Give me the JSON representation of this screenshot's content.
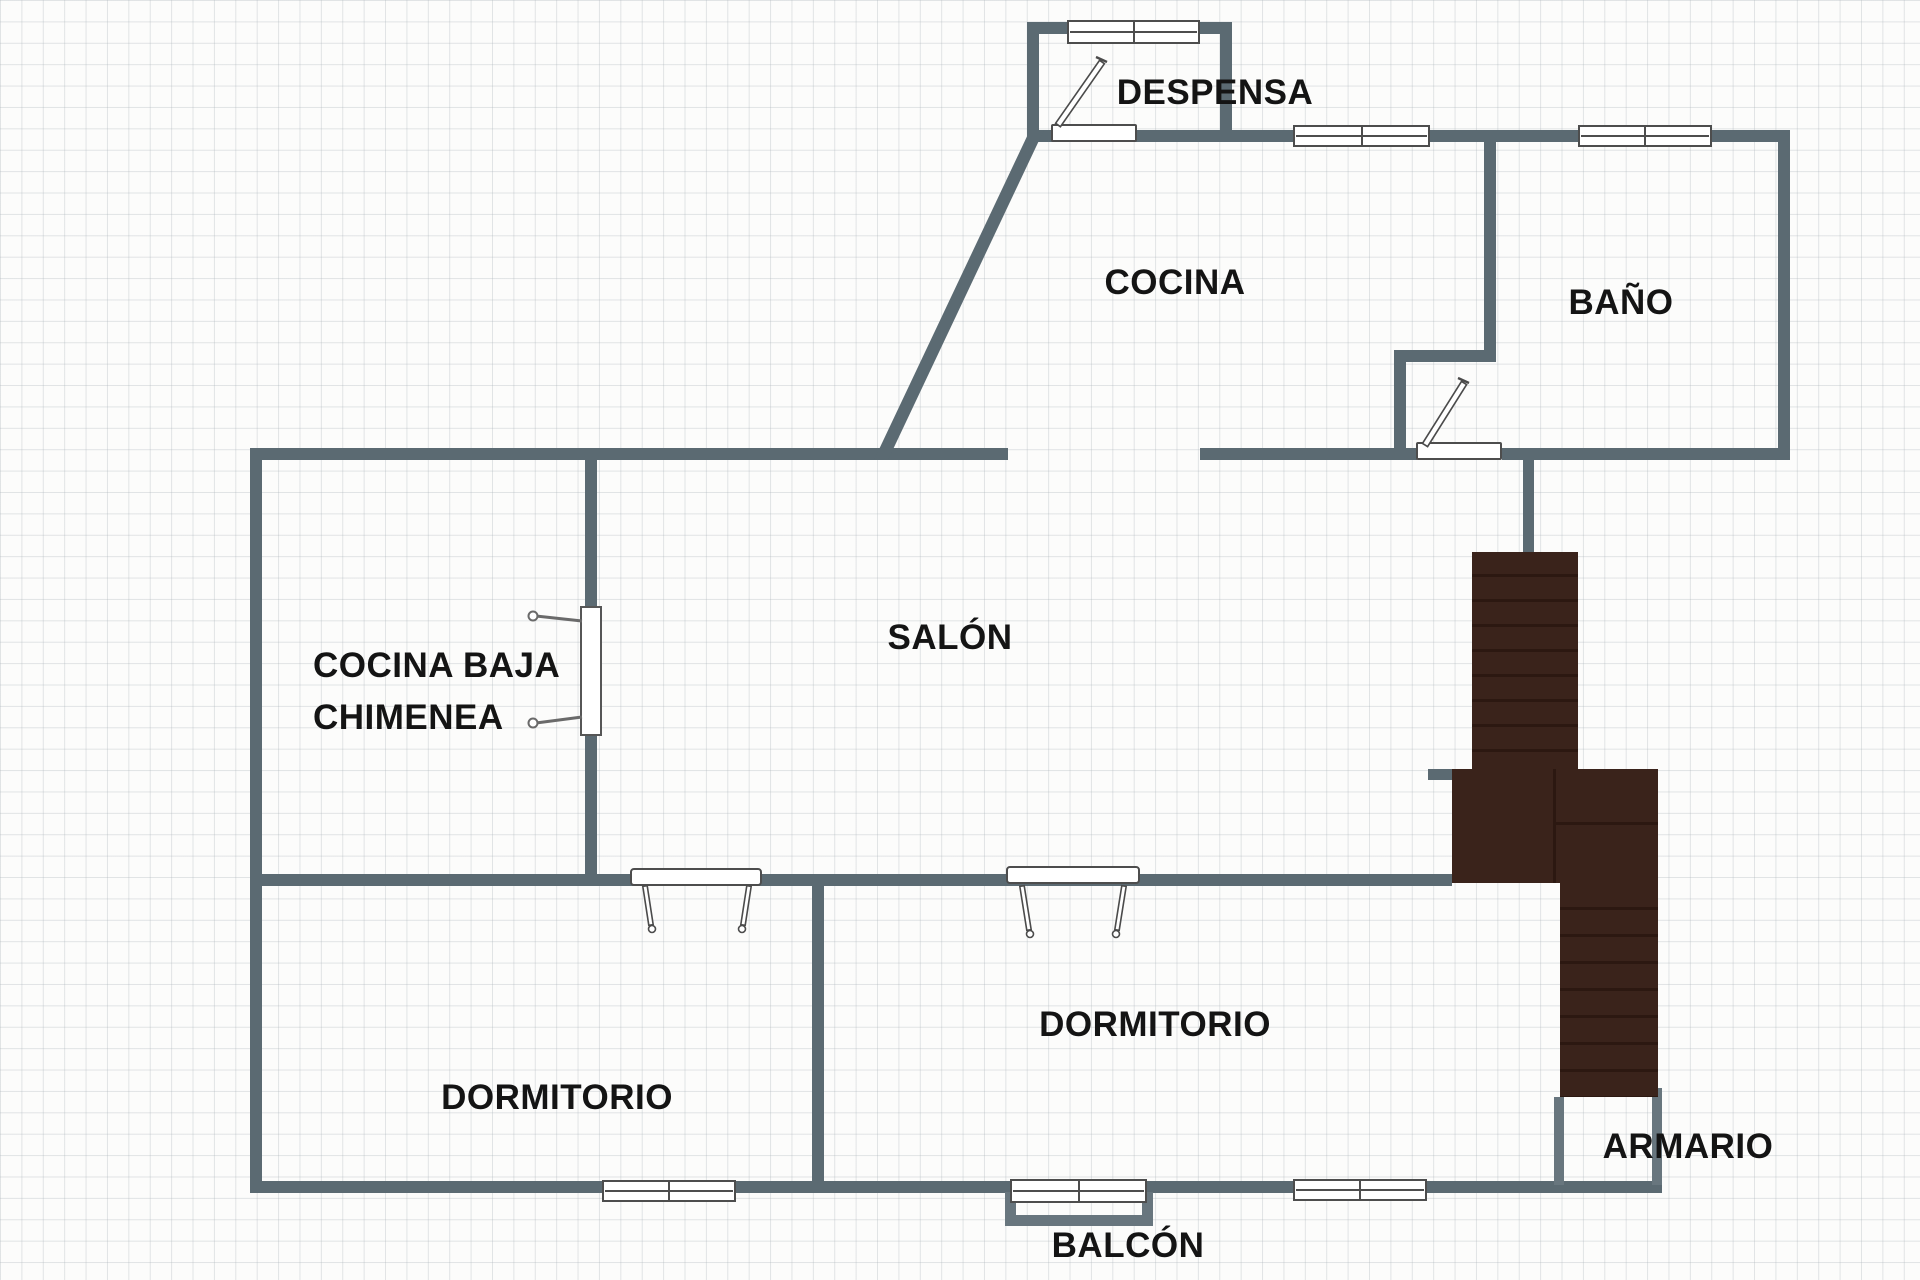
{
  "title": "Plano de planta",
  "rooms": {
    "despensa": {
      "label": "DESPENSA"
    },
    "cocina": {
      "label": "COCINA"
    },
    "bano": {
      "label": "BAÑO"
    },
    "cocina_baja": {
      "label_line1": "COCINA BAJA",
      "label_line2": "CHIMENEA"
    },
    "salon": {
      "label": "SALÓN"
    },
    "dormitorio1": {
      "label": "DORMITORIO"
    },
    "dormitorio2": {
      "label": "DORMITORIO"
    },
    "armario": {
      "label": "ARMARIO"
    },
    "balcon": {
      "label": "BALCÓN"
    }
  },
  "colors": {
    "wall": "#5b6a72",
    "wall2": "#68767e",
    "stair": "#3a231b",
    "stairline": "#2c1811",
    "winborder": "#4d4d4d",
    "paper": "#fcfcfb",
    "text": "#141414"
  },
  "legend": {
    "wall_meaning": "muro",
    "stairs_meaning": "escalera",
    "window_meaning": "ventana",
    "door_meaning": "puerta"
  }
}
